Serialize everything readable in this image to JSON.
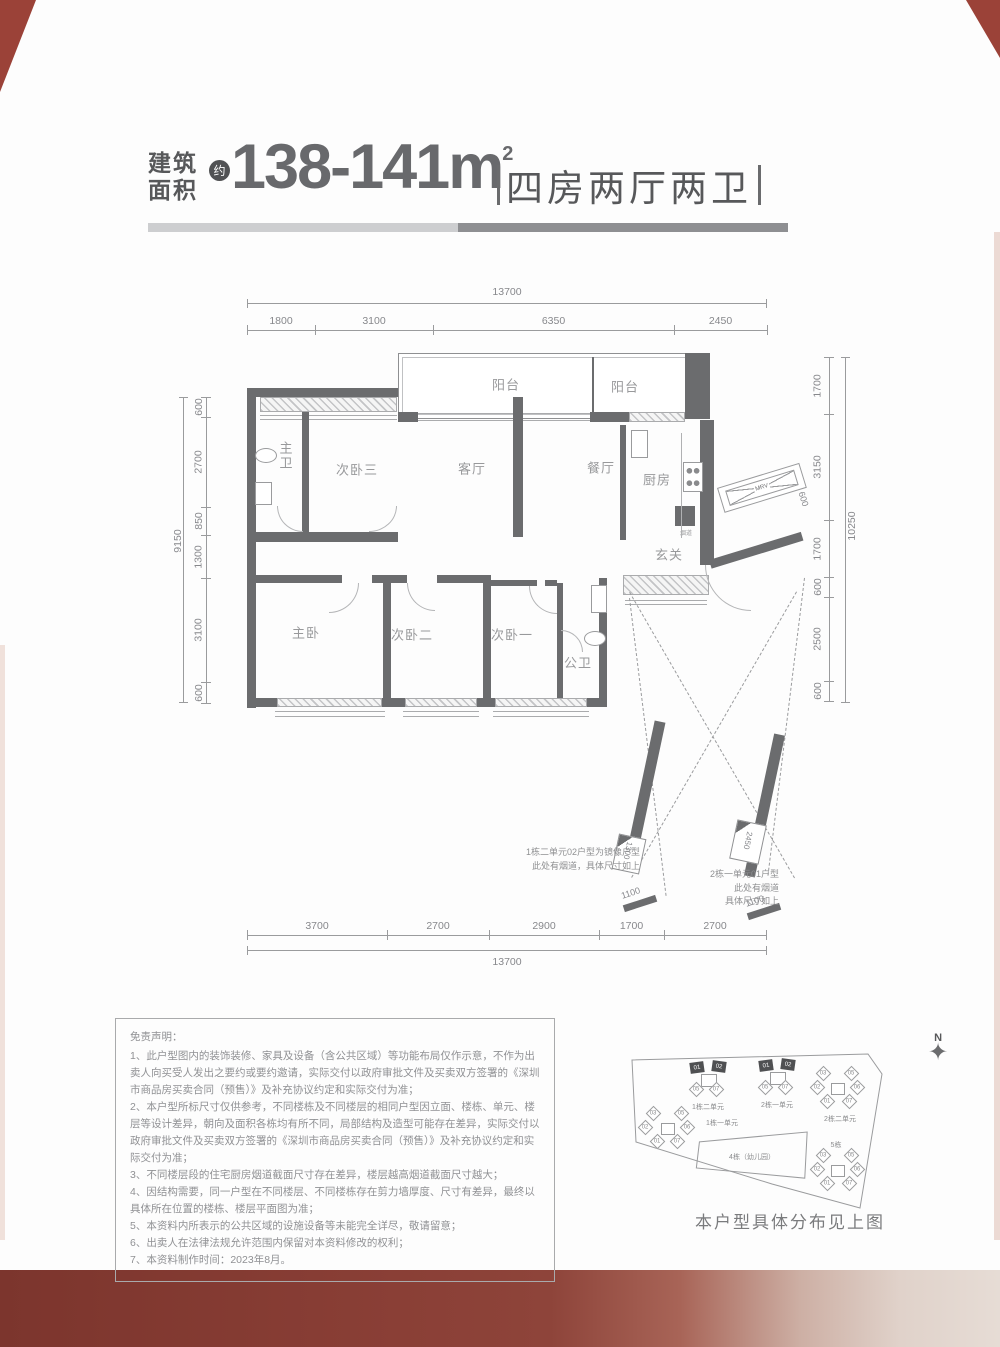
{
  "header": {
    "area_prefix_1": "建筑",
    "area_prefix_2": "面积",
    "approx": "约",
    "area_value": "138-141m",
    "area_exp": "2",
    "layout_text": "四房两厅两卫"
  },
  "floorplan": {
    "rooms": {
      "balcony1": "阳台",
      "balcony2": "阳台",
      "master_bath": "主卫",
      "bedroom3": "次卧三",
      "living": "客厅",
      "dining": "餐厅",
      "kitchen": "厨房",
      "foyer": "玄关",
      "master_bedroom": "主卧",
      "bedroom2": "次卧二",
      "bedroom1": "次卧一",
      "public_bath": "公卫",
      "flue": "烟道",
      "duct": "MRV"
    },
    "dims": {
      "top_total": "13700",
      "top_segments": [
        "1800",
        "3100",
        "6350",
        "2450"
      ],
      "bottom_segments": [
        "3700",
        "2700",
        "2900",
        "1700",
        "2700"
      ],
      "bottom_total": "13700",
      "left_total": "9150",
      "left_segments": [
        "600",
        "2700",
        "850",
        "1300",
        "3100",
        "600"
      ],
      "right_total": "10250",
      "right_segments": [
        "1700",
        "3150",
        "1700",
        "600",
        "2500",
        "600"
      ],
      "duct_600": "600",
      "flue_left_w": "1300",
      "flue_left_off": "1100",
      "flue_right_w": "2450",
      "flue_right_off": "1100"
    },
    "notes": {
      "mirror1": "1栋二单元02户型为镜像户型",
      "mirror2": "此处有烟道，具体尺寸如上",
      "flue1": "2栋一单元01户型",
      "flue2": "此处有烟道",
      "flue3": "具体尺寸如上"
    }
  },
  "disclaimer": {
    "title": "免责声明：",
    "items": [
      "1、此户型图内的装饰装修、家具及设备（含公共区域）等功能布局仅作示意，不作为出卖人向买受人发出之要约或要约邀请，实际交付以政府审批文件及买卖双方签署的《深圳市商品房买卖合同（预售）》及补充协议约定和实际交付为准；",
      "2、本户型所标尺寸仅供参考，不同楼栋及不同楼层的相同户型因立面、楼栋、单元、楼层等设计差异，朝向及面积各栋均有所不同，局部结构及造型可能存在差异，实际交付以政府审批文件及买卖双方签署的《深圳市商品房买卖合同（预售）》及补充协议约定和实际交付为准；",
      "3、不同楼层段的住宅厨房烟道截面尺寸存在差异，楼层越高烟道截面尺寸越大；",
      "4、因结构需要，同一户型在不同楼层、不同楼栋存在剪力墙厚度、尺寸有差异，最终以具体所在位置的楼栋、楼层平面图为准；",
      "5、本资料内所表示的公共区域的设施设备等未能完全详尽，敬请留意；",
      "6、出卖人在法律法规允许范围内保留对本资料修改的权利；",
      "7、本资料制作时间：2023年8月。"
    ]
  },
  "siteplan": {
    "north": "N",
    "star": "✦",
    "caption": "本户型具体分布见上图",
    "clusters": [
      {
        "label": "1栋二单元",
        "top": [
          "01",
          "02"
        ],
        "bottom": [
          "05",
          "07"
        ]
      },
      {
        "label": "2栋一单元",
        "top": [
          "01",
          "02"
        ],
        "bottom": [
          "05",
          "07"
        ]
      },
      {
        "label": "2栋二单元",
        "units": [
          "03",
          "05",
          "02",
          "06",
          "01",
          "07"
        ]
      },
      {
        "label": "1栋一单元",
        "units": [
          "03",
          "05",
          "02",
          "06",
          "01",
          "07"
        ]
      },
      {
        "label": "5栋",
        "units": [
          "03",
          "05",
          "02",
          "06",
          "01",
          "07"
        ]
      },
      {
        "label": "4栋（幼儿园）"
      }
    ]
  },
  "colors": {
    "title_text": "#57585a",
    "big_number": "#68696c",
    "wall": "#6b6c6e",
    "dim_line": "#9a9b9d",
    "room_label": "#98999b",
    "band_dark": "#8a3f36",
    "band_light": "#e6dcd5",
    "corner_red": "#9b4238"
  }
}
